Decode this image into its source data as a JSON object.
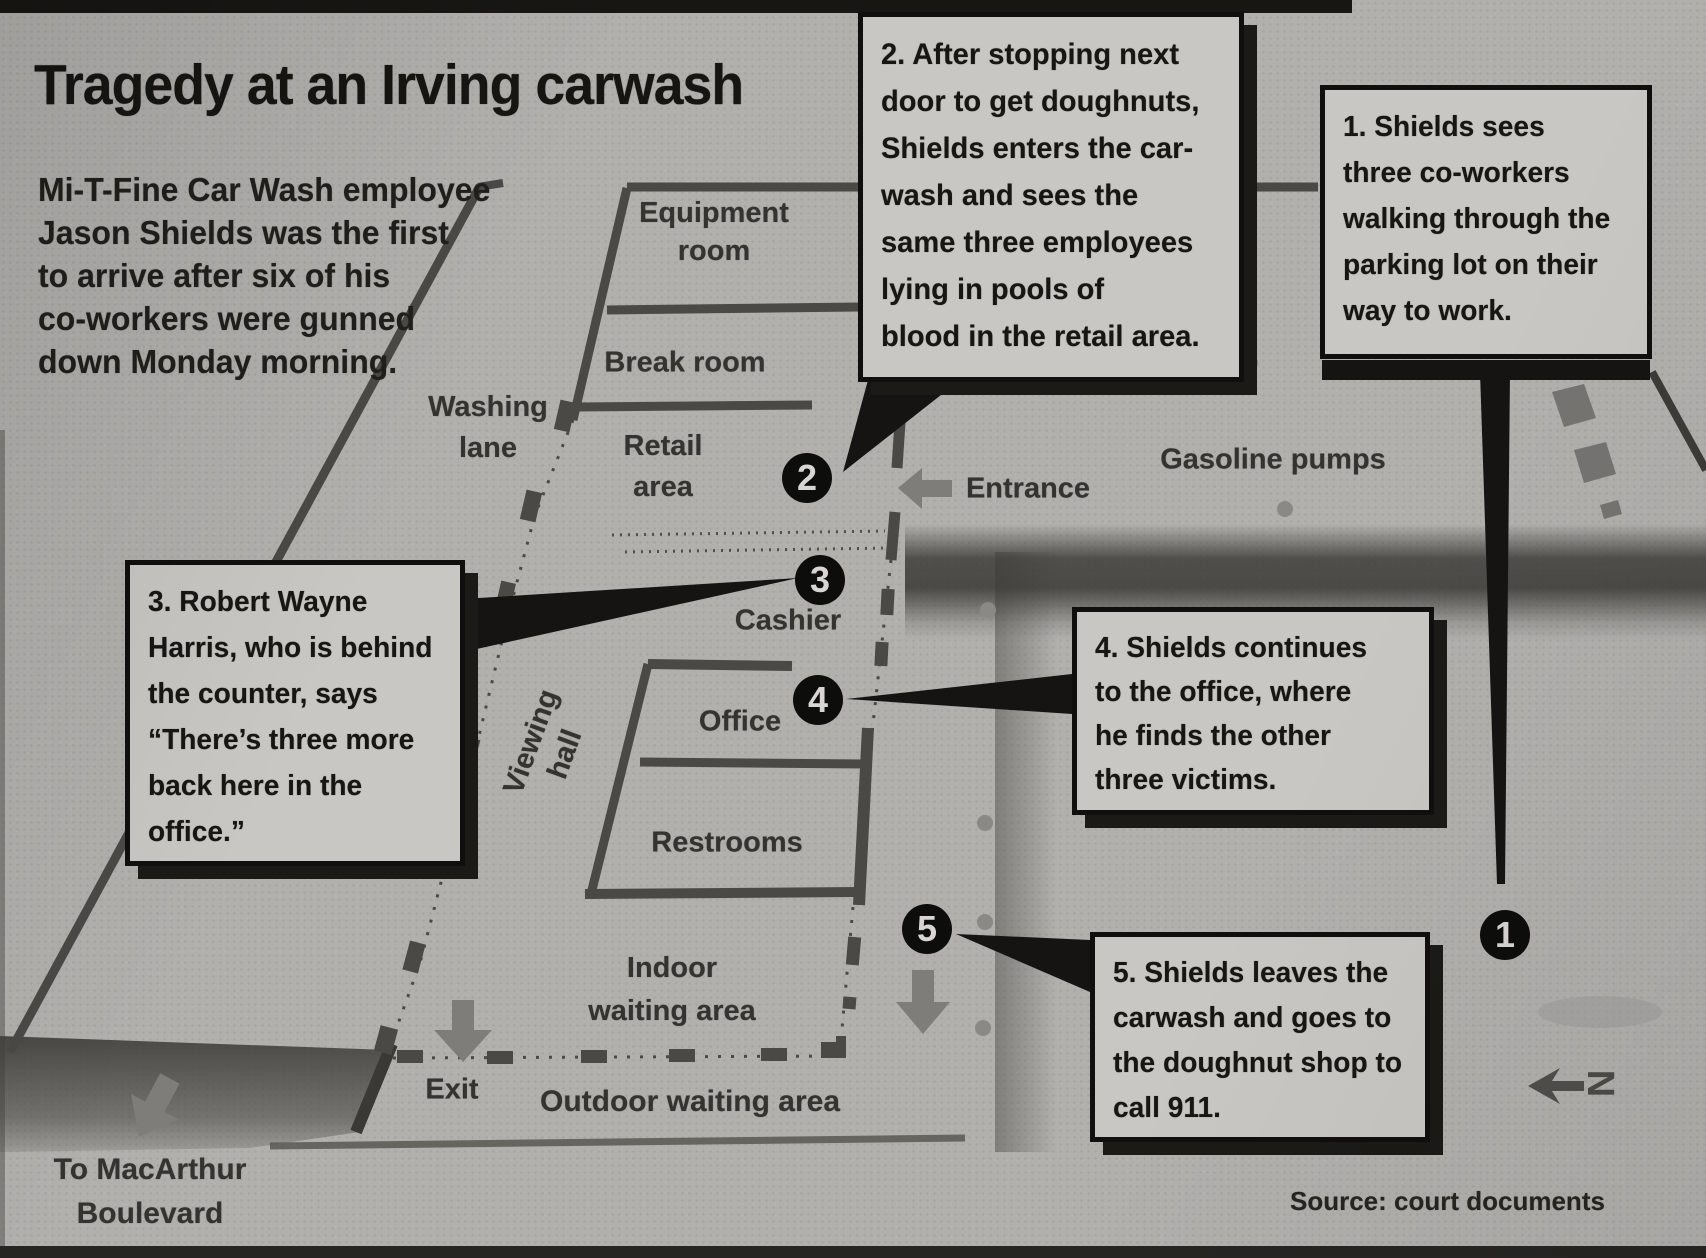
{
  "colors": {
    "paper": "#b1b0ad",
    "ink": "#161511",
    "box_bg": "#c9c7c3",
    "box_border": "#100f0d",
    "wall": "#4a4946",
    "road": "#3e3d39",
    "gray": "#7e7d79",
    "marker_bg": "#0d0d0b",
    "marker_text": "#d8d6d2",
    "label": "#34332f",
    "shadow": "#1b1a17"
  },
  "title": "Tragedy at an Irving carwash",
  "intro": {
    "lines": [
      "Mi-T-Fine Car Wash employee",
      "Jason Shields was the first",
      "to arrive after six of his",
      "co-workers were gunned",
      "down Monday morning."
    ]
  },
  "callouts": [
    {
      "id": "1",
      "lines": [
        "1. Shields sees",
        "three co-workers",
        "walking through the",
        "parking lot on their",
        "way to work."
      ]
    },
    {
      "id": "2",
      "lines": [
        "2. After stopping next",
        "door to get doughnuts,",
        "Shields enters the car-",
        "wash and sees the",
        "same three employees",
        "lying in pools of",
        "blood in the retail area."
      ]
    },
    {
      "id": "3",
      "lines": [
        "3. Robert Wayne",
        "Harris, who is behind",
        "the counter, says",
        "“There’s three more",
        "back here in the",
        "office.”"
      ]
    },
    {
      "id": "4",
      "lines": [
        "4. Shields continues",
        "to the office, where",
        "he finds the other",
        "three victims."
      ]
    },
    {
      "id": "5",
      "lines": [
        "5. Shields leaves the",
        "carwash and goes to",
        "the doughnut shop to",
        "call 911."
      ]
    }
  ],
  "markers": [
    {
      "label": "1"
    },
    {
      "label": "2"
    },
    {
      "label": "3"
    },
    {
      "label": "4"
    },
    {
      "label": "5"
    }
  ],
  "map_labels": {
    "equipment_room": {
      "line1": "Equipment",
      "line2": "room"
    },
    "break_room": "Break room",
    "retail_area": {
      "line1": "Retail",
      "line2": "area"
    },
    "washing_lane": {
      "line1": "Washing",
      "line2": "lane"
    },
    "cashier": "Cashier",
    "viewing_hall": {
      "line1": "Viewing",
      "line2": "hall"
    },
    "office": "Office",
    "restrooms": "Restrooms",
    "indoor_waiting": {
      "line1": "Indoor",
      "line2": "waiting area"
    },
    "outdoor_waiting": "Outdoor waiting area",
    "entrance": "Entrance",
    "exit": "Exit",
    "gasoline_pumps": "Gasoline pumps",
    "to_macarthur": {
      "line1": "To MacArthur",
      "line2": "Boulevard"
    },
    "compass": "N"
  },
  "source": "Source: court documents"
}
